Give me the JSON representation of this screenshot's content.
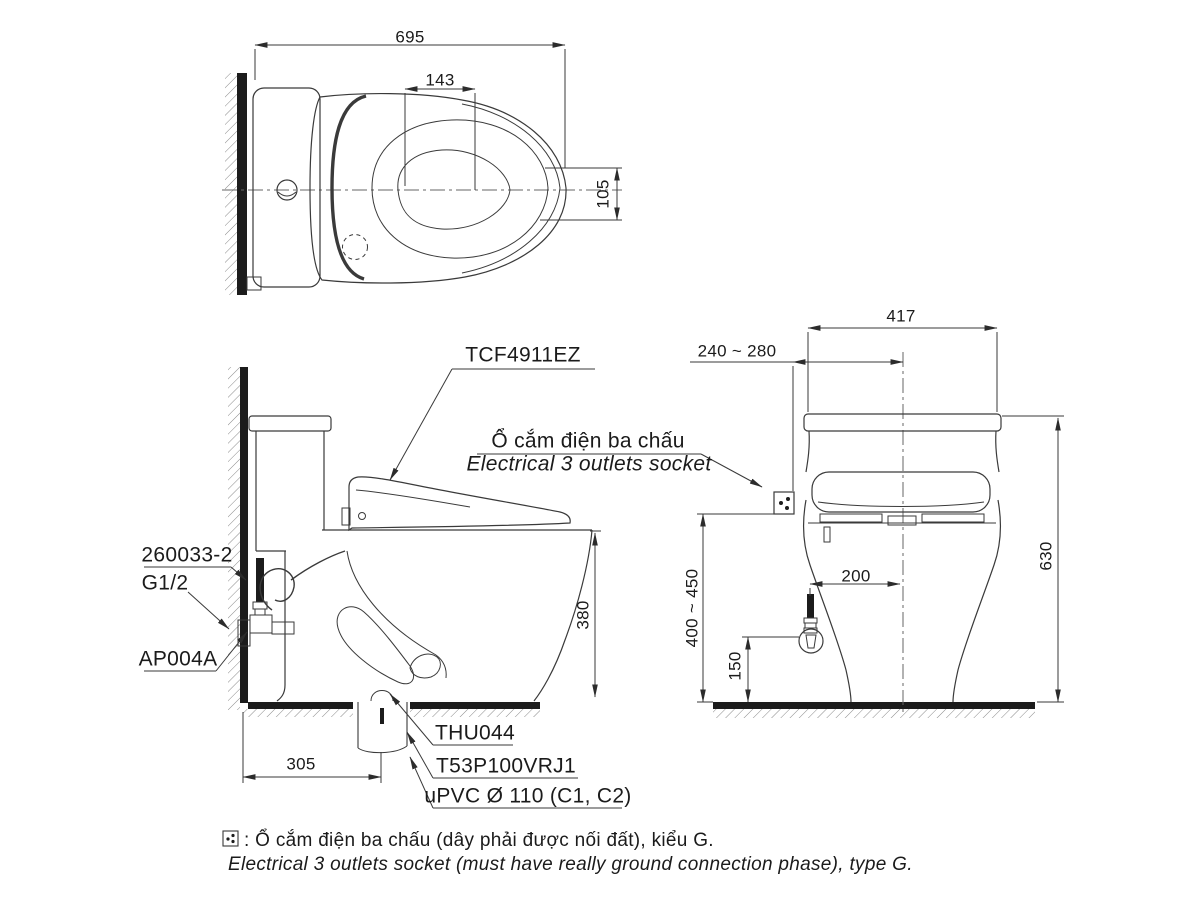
{
  "drawing_title": "TCF4911EZ toilet installation drawing",
  "callouts": {
    "product": "TCF4911EZ",
    "socket_vi": "Ổ cắm điện ba chấu",
    "socket_en": "Electrical 3 outlets socket",
    "supply_hose": "260033-2",
    "thread": "G1/2",
    "angle_valve": "AP004A",
    "drain_flange": "THU044",
    "drain_joint": "T53P100VRJ1",
    "drain_pipe": "uPVC Ø 110 (C1, C2)"
  },
  "dimensions": {
    "top_width": "695",
    "top_inner": "143",
    "top_offset": "105",
    "side_rim_height": "380",
    "side_wall_to_drain": "305",
    "front_tank_width": "417",
    "front_socket_offset": "240 ~ 280",
    "front_total_height": "630",
    "front_socket_height": "400 ~ 450",
    "front_valve_height": "150",
    "front_valve_offset": "200"
  },
  "legend": {
    "vi": ": Ổ cắm điện ba chấu (dây phải được nối đất), kiểu G.",
    "en": "Electrical 3 outlets socket (must have really ground connection phase), type G."
  },
  "colors": {
    "line": "#3a3a3a",
    "solid": "#1c1c1c",
    "hatch": "#8a8a8a",
    "background": "#ffffff"
  }
}
